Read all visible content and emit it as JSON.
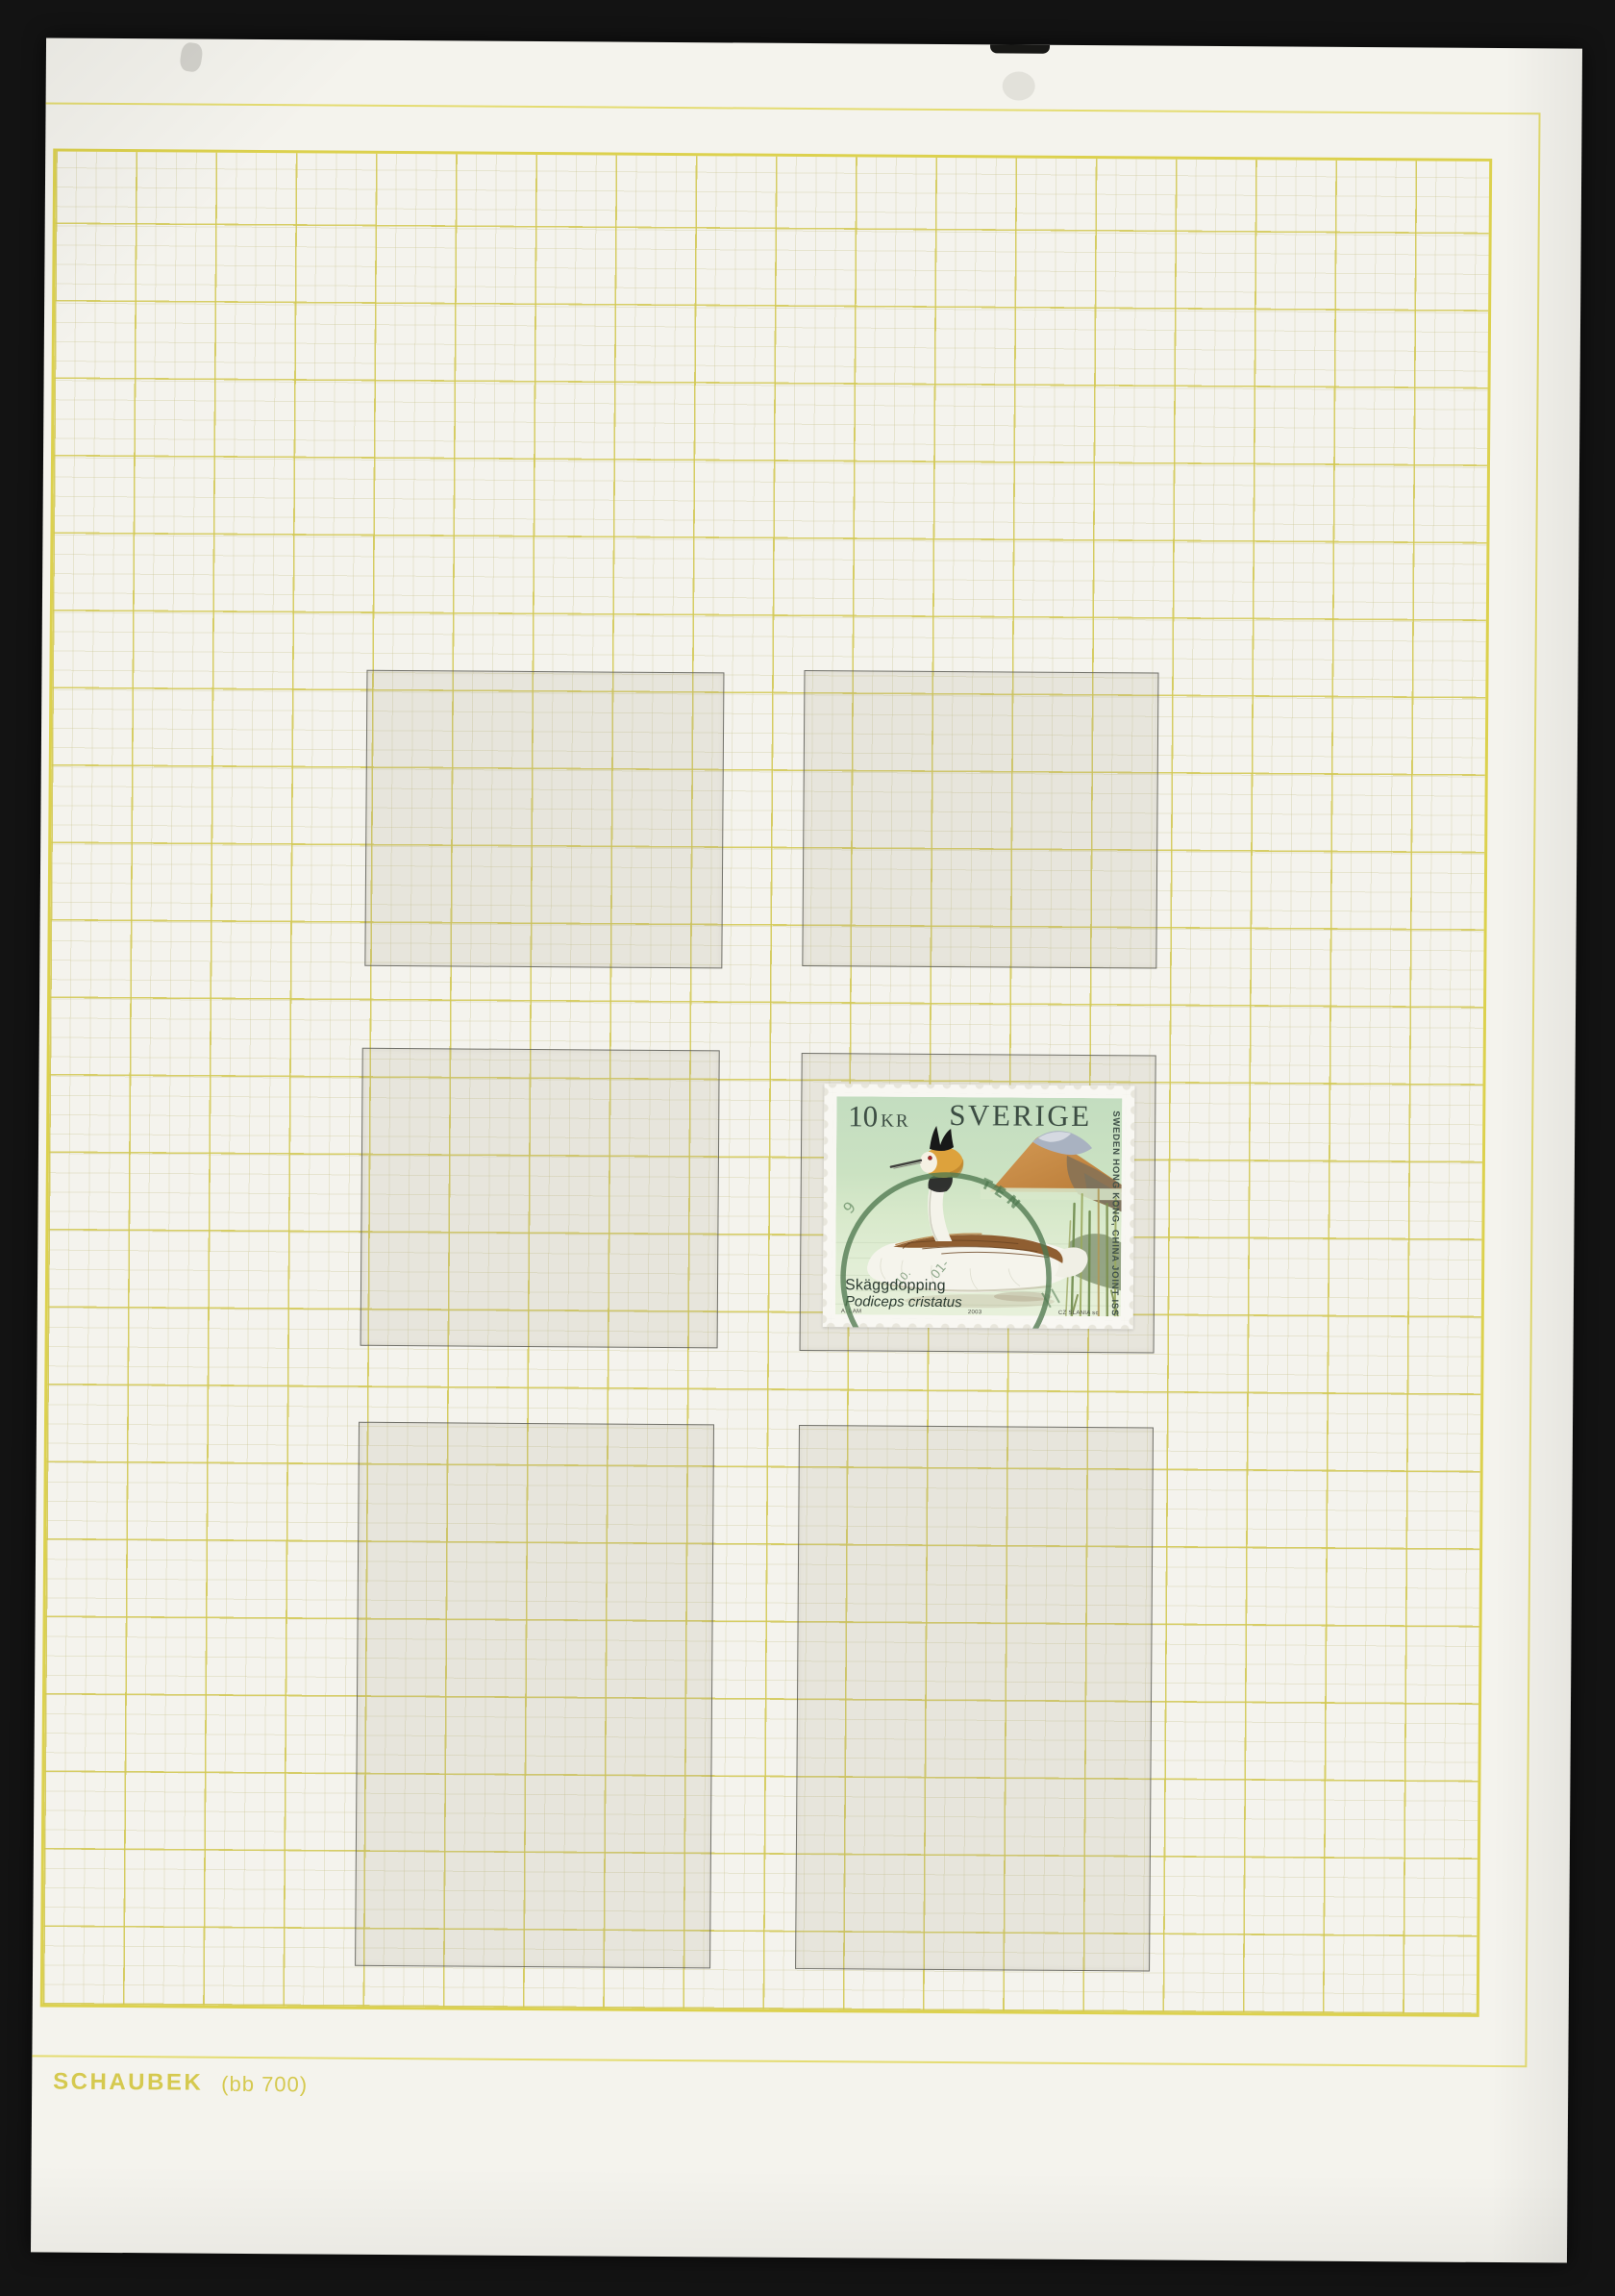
{
  "page": {
    "publisher": "SCHAUBEK",
    "page_code": "(bb 700)",
    "mount_grid": {
      "rows": 3,
      "columns": 2,
      "slots": 6,
      "empty_slots": 5,
      "stamp_slot": "row 2, column 2"
    }
  },
  "stamp": {
    "denomination": "10",
    "currency_unit": "KR",
    "country": "SVERIGE",
    "side_inscription": "SWEDEN HONG KONG, CHINA JOINT ISSUE",
    "species_common_name": "Skäggdopping",
    "species_latin_name": "Podiceps cristatus",
    "designer_credit": "A. LAM",
    "year": "2003",
    "engraver_credit": "CZ SLANIA sc",
    "artwork": "great-crested-grebe-swimming-before-mountain-and-reeds",
    "postmark": {
      "arc_letters": "TEN",
      "date_fragments": [
        "9",
        "01-",
        "-10."
      ]
    }
  },
  "colors": {
    "scan_background": "#131313",
    "paper": "#f4f3ed",
    "grid_major": "#d2c850",
    "grid_frame": "#dcd14e",
    "page_border_line": "#e4dc72",
    "footer_text": "#d5c94f",
    "mount_line": "#58584f",
    "stamp_paper": "#f8f7f2",
    "stamp_text": "#3c4d43",
    "stamp_background_green": "#cbe2c2",
    "postmark_green": "#4f784f"
  }
}
